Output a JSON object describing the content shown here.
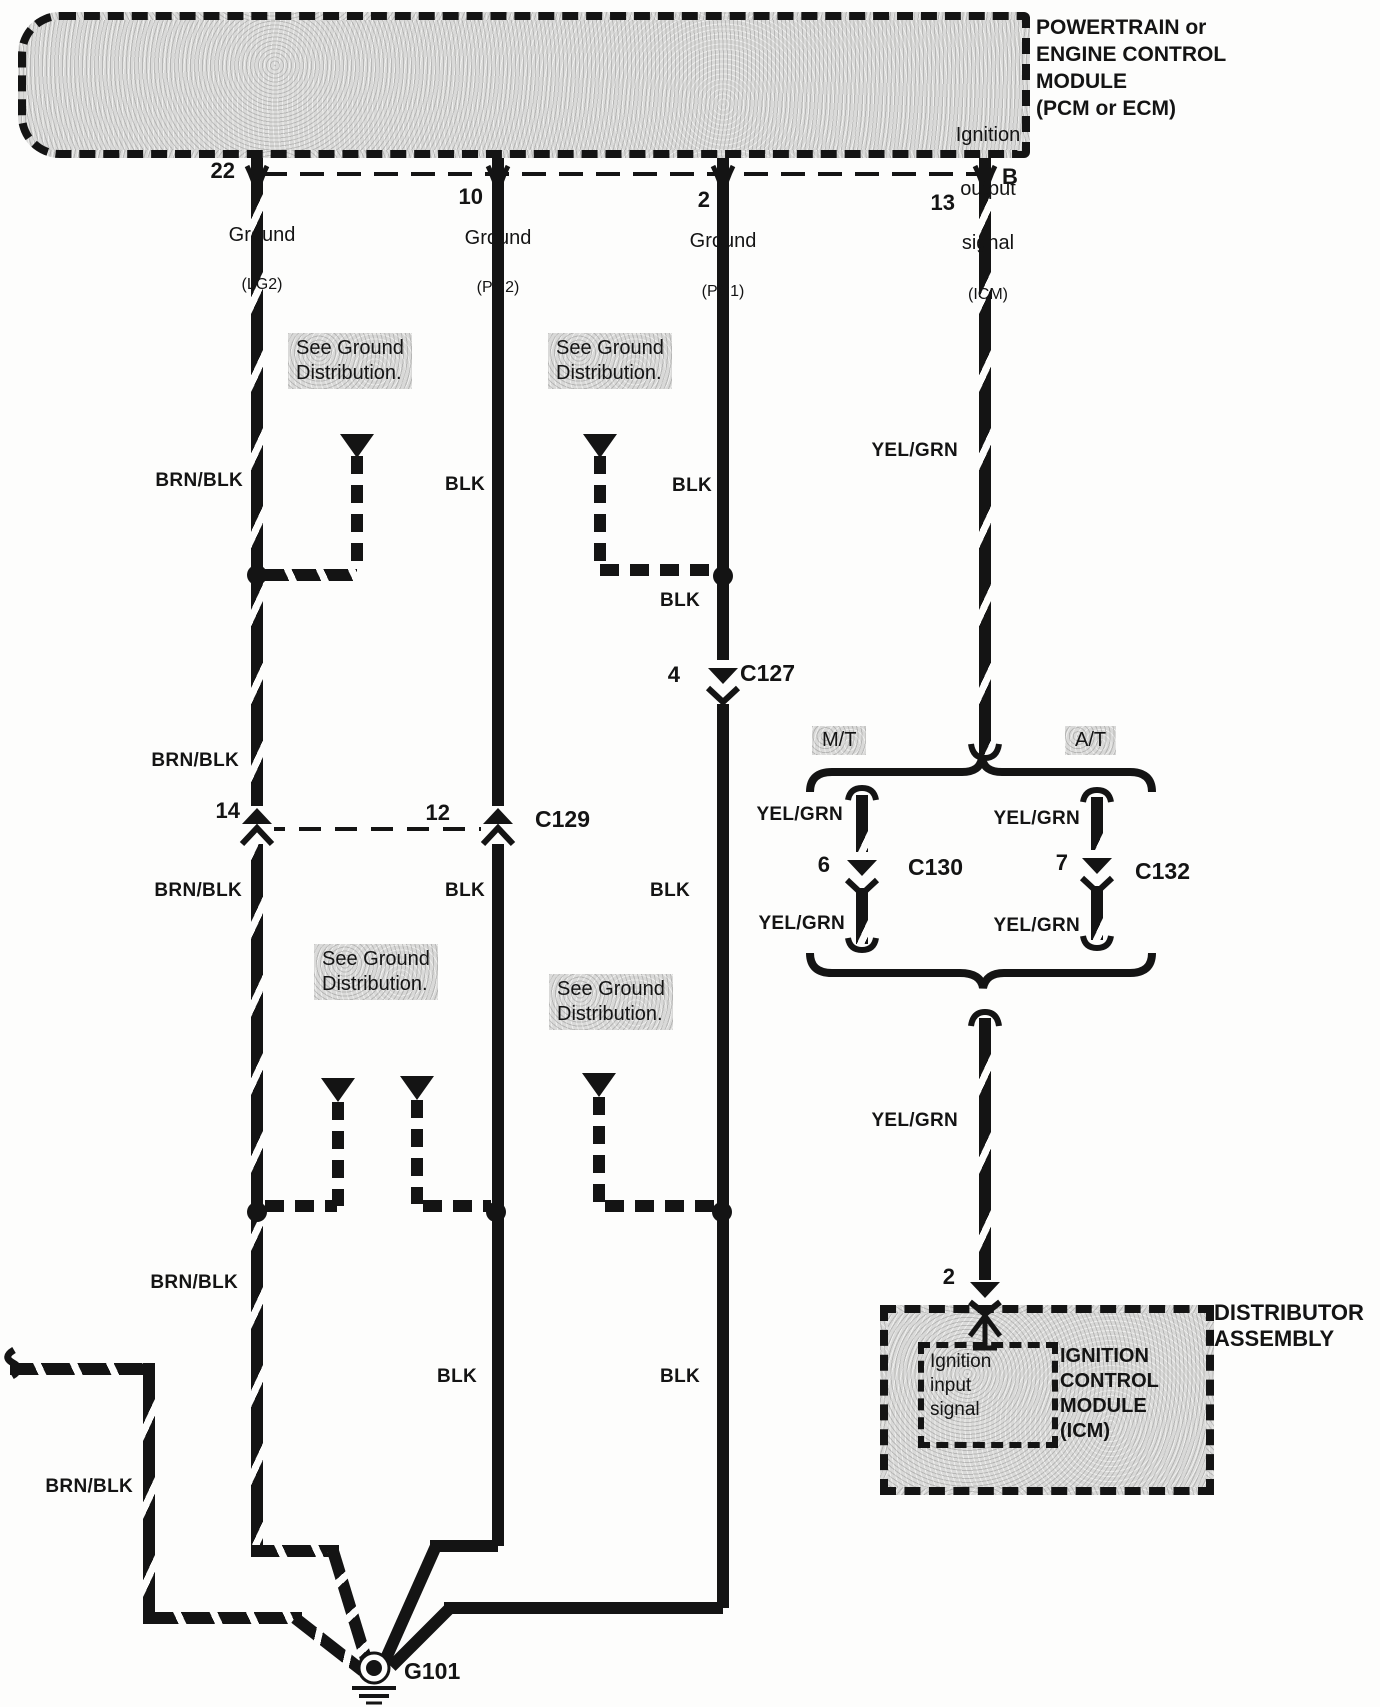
{
  "colors": {
    "ink": "#141414",
    "paper": "#fdfdfc",
    "stipple": "#d9d9d8"
  },
  "pcm": {
    "title_lines": [
      "POWERTRAIN or",
      "ENGINE CONTROL",
      "MODULE",
      "(PCM or ECM)"
    ],
    "pins": [
      {
        "label": "Ground",
        "sub": "(LG2)",
        "number": "22"
      },
      {
        "label": "Ground",
        "sub": "(PG2)",
        "number": "10"
      },
      {
        "label": "Ground",
        "sub": "(PG1)",
        "number": "2"
      },
      {
        "label_lines": [
          "Ignition",
          "output",
          "signal"
        ],
        "sub": "(ICM)",
        "number": "13",
        "letter": "B"
      }
    ]
  },
  "wire_colors": {
    "brn_blk": "BRN/BLK",
    "blk": "BLK",
    "yel_grn": "YEL/GRN"
  },
  "notes": {
    "see_ground_1": "See Ground",
    "see_ground_2": "Distribution."
  },
  "connectors": {
    "c127": {
      "pin": "4",
      "id": "C127"
    },
    "c129": {
      "pin_left": "14",
      "pin_right": "12",
      "id": "C129"
    },
    "c130": {
      "pin": "6",
      "id": "C130"
    },
    "c132": {
      "pin": "7",
      "id": "C132"
    },
    "dist_pin": "2"
  },
  "transmission": {
    "mt": "M/T",
    "at": "A/T"
  },
  "distributor": {
    "assembly_lines": [
      "DISTRIBUTOR",
      "ASSEMBLY"
    ],
    "icm_lines": [
      "IGNITION",
      "CONTROL",
      "MODULE",
      "(ICM)"
    ],
    "input_lines": [
      "Ignition",
      "input",
      "signal"
    ]
  },
  "ground": {
    "id": "G101"
  }
}
